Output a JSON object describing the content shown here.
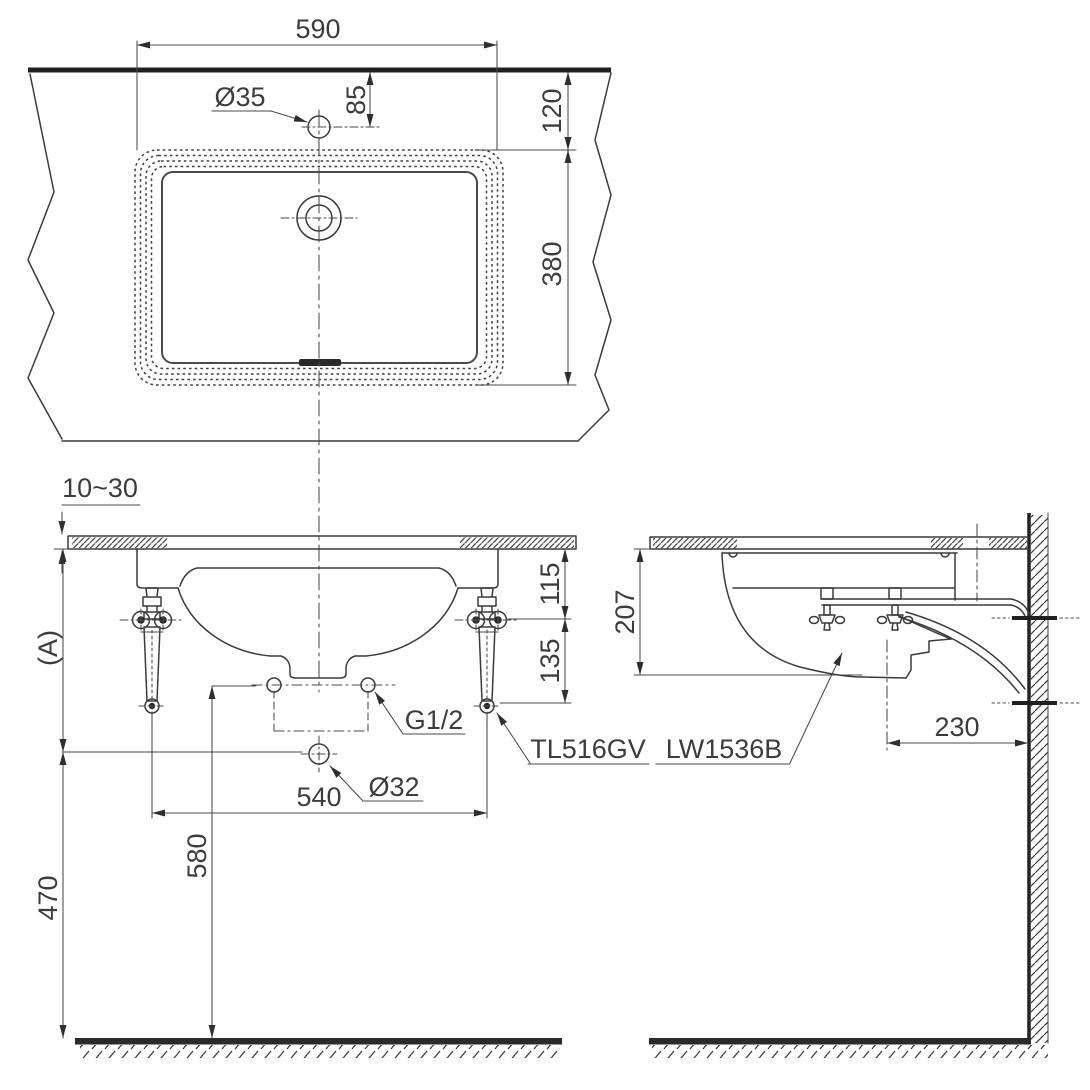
{
  "style": {
    "line_color": "#3b3b3b",
    "text_color": "#3c3c3c",
    "background": "#ffffff"
  },
  "top_view": {
    "rim_width": "590",
    "faucet_hole_diameter": "Ø35",
    "faucet_hole_offset": "85",
    "edge_to_rim": "120",
    "rim_depth": "380"
  },
  "front_view": {
    "counter_thickness": "10~30",
    "counter_height_ref": "(A)",
    "counter_to_supply": "115",
    "supply_to_valve_end": "135",
    "supply_thread": "G1/2",
    "drain_diameter": "Ø32",
    "valve_spacing": "540",
    "floor_to_supply": "580",
    "floor_to_drain": "470",
    "valve_model": "TL516GV"
  },
  "side_view": {
    "basin_height": "207",
    "drain_to_wall": "230",
    "basin_model": "LW1536B"
  }
}
